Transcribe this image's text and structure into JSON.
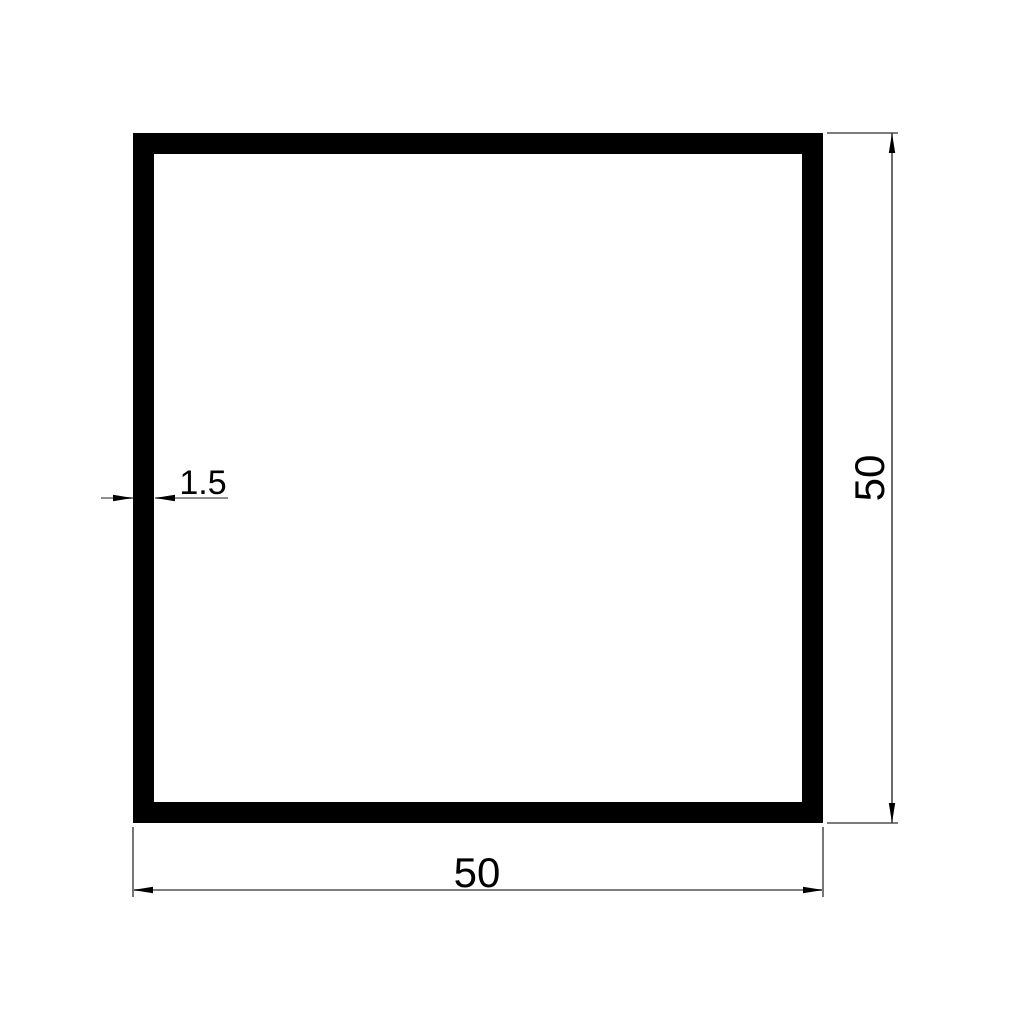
{
  "drawing": {
    "kind": "square-tube-cross-section"
  },
  "dimensions": {
    "width": {
      "label": "50",
      "value": 50
    },
    "height": {
      "label": "50",
      "value": 50
    },
    "wall_thickness": {
      "label": "1.5",
      "value": 1.5
    }
  },
  "colors": {
    "background": "#ffffff",
    "profile_outline": "#000000",
    "profile_fill": "#ffffff",
    "dim_line_gray": "#7e7e7e",
    "dim_line_dark": "#3c3c3c",
    "extension_line": "#2f2f2f",
    "arrow": "#000000",
    "text": "#000000"
  }
}
